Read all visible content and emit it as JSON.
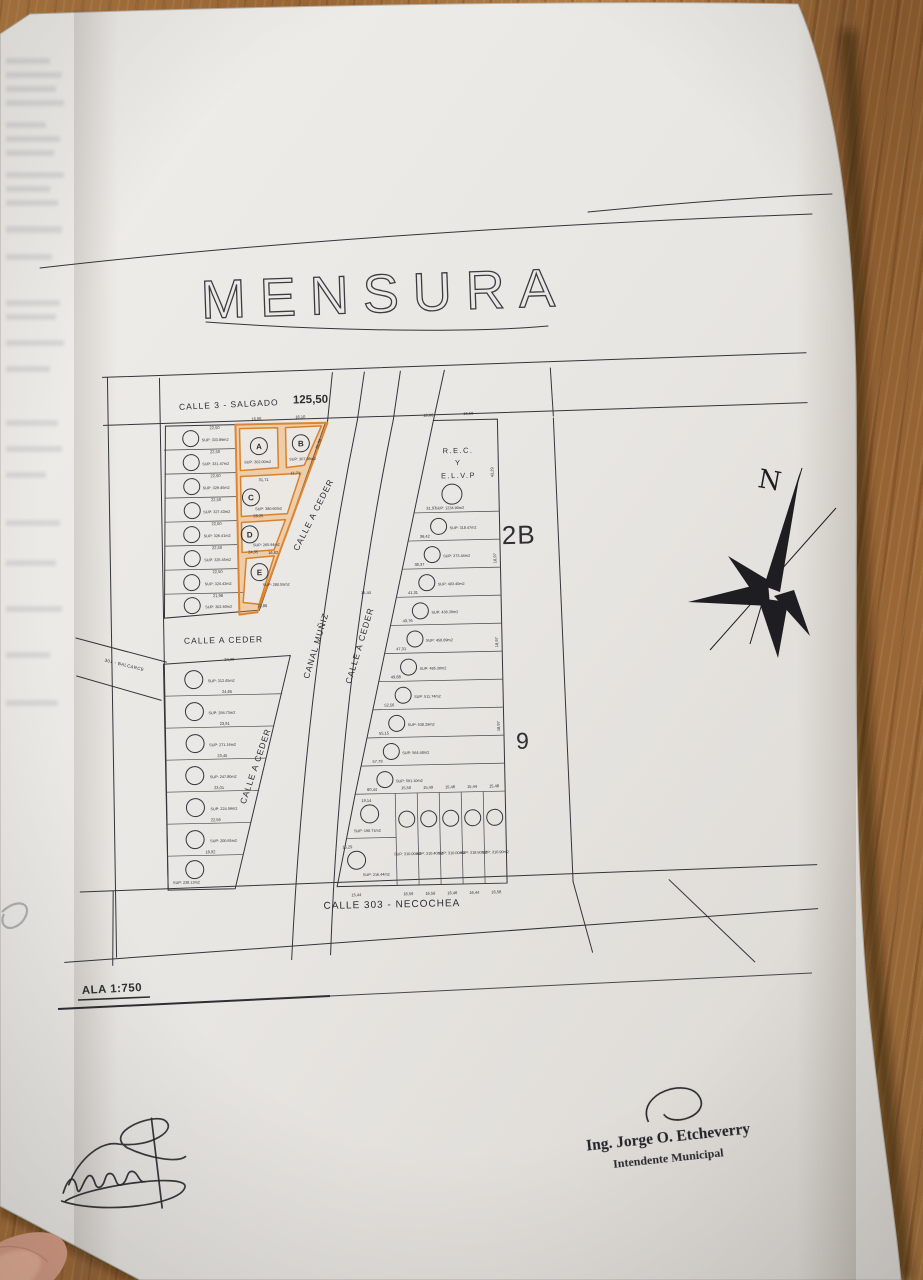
{
  "doc": {
    "title": "MENSURA",
    "scale_label": "ALA 1:750",
    "north_label": "N",
    "streets": {
      "top": "CALLE 3 - SALGADO",
      "top_length": "125,50",
      "left_cross": "301 - BALCARCE",
      "ceder_upper": "CALLE A CEDER",
      "ceder_mid": "CALLE A CEDER",
      "ceder_lower": "CALLE A CEDER",
      "ceder_east": "CALLE A CEDER",
      "canal": "CANAL MUÑIZ",
      "bottom": "CALLE 303 - NECOCHEA"
    },
    "block_labels": {
      "northeast": "2B",
      "east": "9"
    },
    "rec_parcel": {
      "line1": "R.E.C.",
      "line2": "Y",
      "line3": "E.L.V.P",
      "sup": "SUP: 1234.90m2",
      "dim_top_left": "16,06",
      "dim_top_right": "16,50",
      "dim_right": "43,29"
    },
    "lettered_parcels": [
      {
        "label": "A",
        "sup": "SUP: 302.00m2",
        "dim_top": "16,00"
      },
      {
        "label": "B",
        "sup": "SUP: 307.98m2",
        "dim_top": "16,10",
        "dim_bottom": "11,71",
        "dim_right": "21,59"
      },
      {
        "label": "C",
        "sup": "SUP: 380.60m2",
        "dim_top": "31,71",
        "dim_bottom": "28,25"
      },
      {
        "label": "D",
        "sup": "SUP: 265.94m2",
        "dim_bottom": "24,35"
      },
      {
        "label": "E",
        "sup": "SUP: 280.55m2",
        "dim_top": "16,82",
        "dim_bottom": "15,86"
      }
    ],
    "west_upper_lots": [
      {
        "sup": "SUP: 333.89m2",
        "dim": "22,50"
      },
      {
        "sup": "SUP: 331.47m2",
        "dim": "22,50"
      },
      {
        "sup": "SUP: 329.45m2",
        "dim": "22,50"
      },
      {
        "sup": "SUP: 327.43m2",
        "dim": "22,50"
      },
      {
        "sup": "SUP: 326.41m2",
        "dim": "22,50"
      },
      {
        "sup": "SUP: 325.45m2",
        "dim": "22,50"
      },
      {
        "sup": "SUP: 324.43m2",
        "dim": "22,50"
      },
      {
        "sup": "SUP: 302.60m2",
        "dim": "21,98"
      }
    ],
    "west_lower_lots": [
      {
        "sup": "SUP: 312.45m2",
        "dim": "24,99"
      },
      {
        "sup": "SUP: 294.73m2",
        "dim": "24,65"
      },
      {
        "sup": "SUP: 271.16m2",
        "dim": "23,91"
      },
      {
        "sup": "SUP: 247.80m2",
        "dim": "23,45"
      },
      {
        "sup": "SUP: 224.59m2",
        "dim": "23,01"
      },
      {
        "sup": "SUP: 200.65m2",
        "dim": "22,56"
      },
      {
        "sup": "SUP: 238.13m2",
        "dim": "18,92"
      }
    ],
    "east_strip_lots": [
      {
        "sup": "SUP: 318.47m2",
        "dim": "31,97"
      },
      {
        "sup": "SUP: 373.44m2",
        "dim": "36,42"
      },
      {
        "sup": "SUP: 403.40m2",
        "dim": "38,37"
      },
      {
        "sup": "SUP: 436.39m2",
        "dim": "41,31"
      },
      {
        "sup": "SUP: 458.89m2",
        "dim": "43,76"
      },
      {
        "sup": "SUP: 485.30m2",
        "dim": "47,31"
      },
      {
        "sup": "SUP: 511.74m2",
        "dim": "49,88"
      },
      {
        "sup": "SUP: 538.29m2",
        "dim": "52,56"
      },
      {
        "sup": "SUP: 564.48m2",
        "dim": "55,15"
      },
      {
        "sup": "SUP: 591.10m2",
        "dim": "57,79"
      }
    ],
    "east_strip_dim_last": "60,44",
    "east_strip_dim_right": "18,97",
    "east_corner_lots": [
      {
        "sup": "SUP: 190.71m2",
        "dim": "19,14"
      },
      {
        "sup": "SUP: 216.44m2",
        "dim": "15,29"
      }
    ],
    "east_corner_dim_bottom": "15,44",
    "east_row_lots": [
      {
        "sup": "SUP: 310.00m2",
        "dim_top": "15,50",
        "dim_bottom": "16,59"
      },
      {
        "sup": "SUP: 310.40m2",
        "dim_top": "15,49",
        "dim_bottom": "16,56"
      },
      {
        "sup": "SUP: 310.00m2",
        "dim_top": "15,46",
        "dim_bottom": "16,46"
      },
      {
        "sup": "SUP: 318.50m2",
        "dim_top": "15,44",
        "dim_bottom": "16,44"
      },
      {
        "sup": "SUP: 310.90m2",
        "dim_top": "15,48",
        "dim_bottom": "16,58"
      }
    ],
    "misc": {
      "street_gap": "15,44"
    },
    "stamp": {
      "name": "Ing. Jorge O. Etcheverry",
      "role": "Intendente Municipal"
    }
  }
}
